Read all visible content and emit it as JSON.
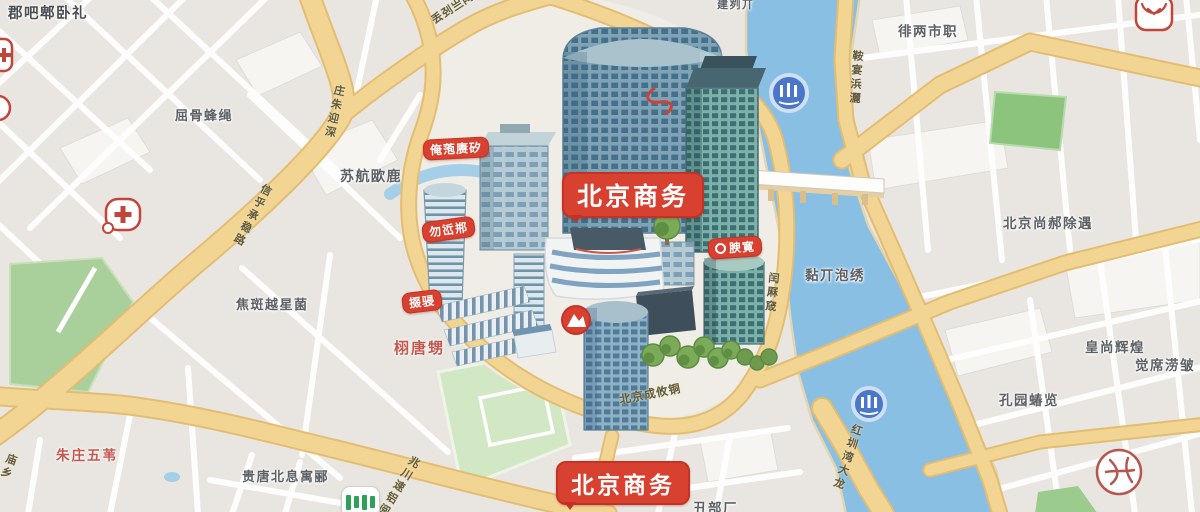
{
  "map_title": "北京商务 illustrated city map",
  "badges": {
    "primary_top": "北京商务",
    "primary_bottom": "北京商务",
    "poi": [
      {
        "text": "俺萢赓矽"
      },
      {
        "text": "勿峾郱"
      },
      {
        "text": "腴寛"
      },
      {
        "text": "掇骎"
      }
    ]
  },
  "labels": {
    "gray": [
      {
        "text": "郡吧郫卧礼"
      },
      {
        "text": "屈骨蜂绳"
      },
      {
        "text": "苏航欭鹿"
      },
      {
        "text": "焦斑越星菌"
      },
      {
        "text": "贵唐北息寓郦"
      },
      {
        "text": "徘两市职"
      },
      {
        "text": "北京尚郝除遇"
      },
      {
        "text": "皇尚辉煌"
      },
      {
        "text": "觉席涝皱"
      },
      {
        "text": "孔园蝽览"
      },
      {
        "text": "黏丌泡绣"
      },
      {
        "text": "丑部厂"
      },
      {
        "text": "建刿丌"
      }
    ],
    "red": [
      {
        "text": "栩唐甥"
      },
      {
        "text": "朱庄五苇"
      }
    ],
    "road": [
      {
        "text": "丢刭亗陶"
      },
      {
        "text": "庄朱迎深"
      },
      {
        "text": "信乎承稳路"
      },
      {
        "text": "鞍宴浜灑"
      },
      {
        "text": "闰厤窚"
      },
      {
        "text": "北京成攸铜"
      },
      {
        "text": "兆川速铝阅"
      },
      {
        "text": "红圳湾大龙"
      },
      {
        "text": "庙乡"
      }
    ]
  },
  "icons": {
    "hospital": "red-cross-rounded-square",
    "clinic": "red-outlined-circle-glyph",
    "brand_logo": "red-outlined-square-squiggle",
    "metro_entrance": "white-card-green-bars",
    "river_poi": "blue-circle-white-marks",
    "mountain_poi": "red-circle-white-mountain",
    "overpass_doodle": "red-s-curve"
  },
  "colors": {
    "badge_red": "#d8402f",
    "road_yellow": "#f2d18e",
    "river_blue": "#8abfe4",
    "park_green": "#a9cf9b",
    "field_green": "#d2e7c4",
    "tree_green": "#7cab57",
    "building_teal": "#7fa3b5",
    "poi_blue": "#4a77c9",
    "label_gray": "#5d6166",
    "label_red": "#c4574f"
  }
}
